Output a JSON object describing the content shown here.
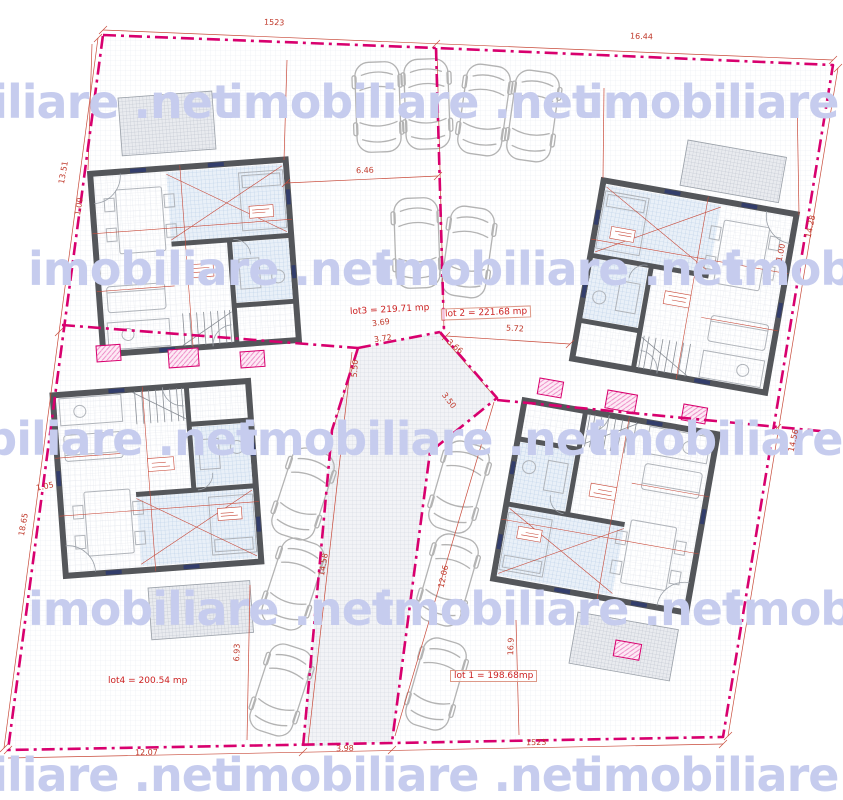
{
  "watermark": {
    "text": "imobiliare .net",
    "color": "#c6ccee"
  },
  "lots": [
    {
      "name": "lot 1",
      "label": "lot 1 = 198.68mp"
    },
    {
      "name": "lot 2",
      "label": "lot 2 = 221.68 mp"
    },
    {
      "name": "lot 3",
      "label": "lot3 = 219.71 mp"
    },
    {
      "name": "lot 4",
      "label": "lot4 = 200.54 mp"
    }
  ],
  "dims": [
    "1523",
    "16.44",
    "13.51",
    "18.65",
    "14.28",
    "14.56",
    "12.07",
    "3.98",
    "1523",
    "6.46",
    "5.72",
    "3.69",
    "3.72",
    "3.66",
    "3.50",
    "5.50",
    "14.58",
    "12.06",
    "6.93",
    "16.9",
    "1.00",
    "1.00",
    "1.05"
  ],
  "colors": {
    "boundary": "#d8006e",
    "dimension": "#c0392b",
    "walls": "#54565a",
    "blue_hatch": "#b7cde6",
    "watermark": "#c6ccee"
  }
}
